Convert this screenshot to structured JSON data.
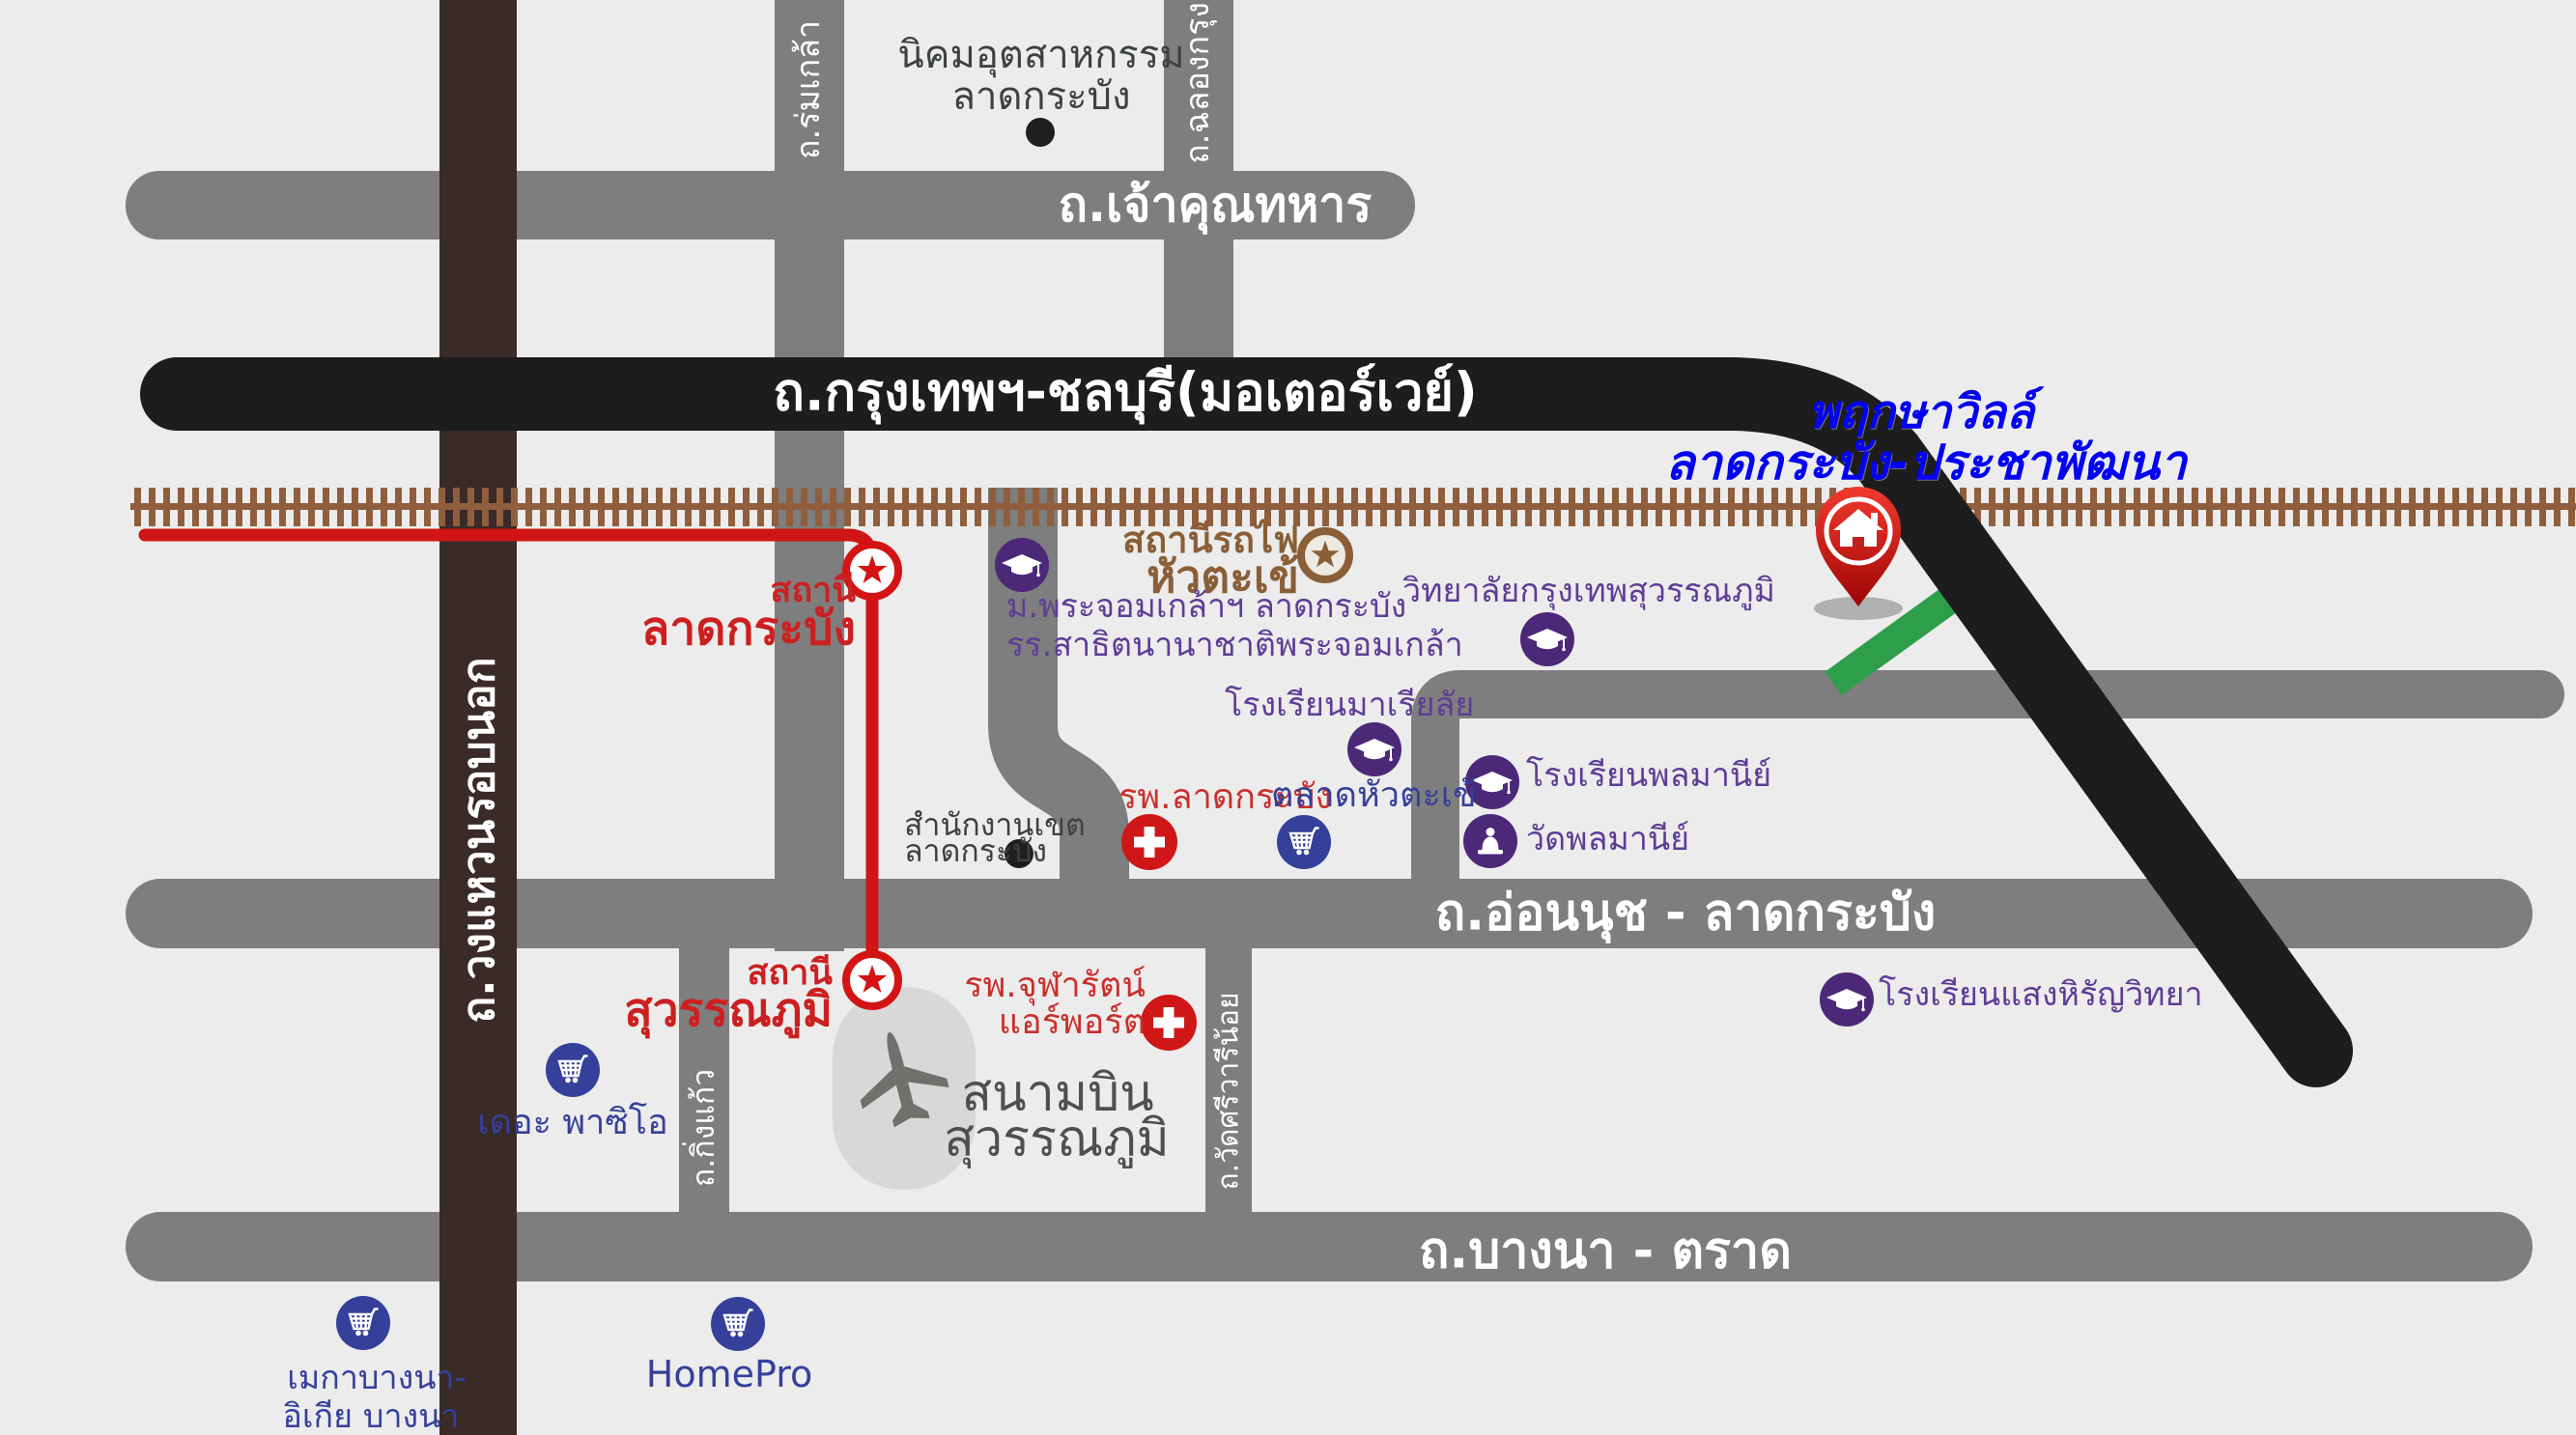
{
  "colors": {
    "background": "#ececec",
    "road_gray": "#7e7e7e",
    "motorway_black": "#1d1d1d",
    "ring_road_brown": "#3a2a28",
    "railway_brown": "#8f5f3d",
    "rail_line_red": "#cf1515",
    "route_green": "#2f9e4a",
    "education_purple": "#4b2878",
    "shopping_blue": "#35409a",
    "hospital_red": "#cf1717",
    "project_blue": "#0404f0",
    "station_brown": "#8a5f38"
  },
  "project": {
    "line1": "พฤกษาวิลล์",
    "line2": "ลาดกระบัง-ประชาพัฒนา"
  },
  "roads": {
    "ring_road": "ถ.วงแหวนรอบนอก",
    "romklao": "ถ.ร่มเกล้า",
    "chalongkrung": "ถ.ฉลองกรุง",
    "chaokhun_thahan": "ถ.เจ้าคุณทหาร",
    "motorway": "ถ.กรุงเทพฯ-ชลบุรี(มอเตอร์เวย์)",
    "onnut_latkrabang": "ถ.อ่อนนุช - ลาดกระบัง",
    "bangna_trat": "ถ.บางนา - ตราด",
    "kingkaeo": "ถ.กิ่งแก้ว",
    "wat_sriwari_noi": "ถ.วัดศรีวารีน้อย"
  },
  "stations": {
    "lat_krabang": {
      "prefix": "สถานี",
      "name": "ลาดกระบัง"
    },
    "suvarnabhumi": {
      "prefix": "สถานี",
      "name": "สุวรรณภูมิ"
    },
    "hua_takhe": {
      "prefix": "สถานีรถไฟ",
      "name": "หัวตะเข้"
    }
  },
  "places": {
    "industrial_estate": {
      "line1": "นิคมอุตสาหกรรม",
      "line2": "ลาดกระบัง"
    },
    "kmitl": {
      "line1": "ม.พระจอมเกล้าฯ ลาดกระบัง",
      "line2": "รร.สาธิตนานาชาติพระจอมเกล้า"
    },
    "bangkok_suvarnabhumi_college": "วิทยาลัยกรุงเทพสุวรรณภูมิ",
    "marialai_school": "โรงเรียนมาเรียลัย",
    "lat_krabang_hospital": "รพ.ลาดกระบัง",
    "hua_takhe_market": "ตลาดหัวตะเข้",
    "district_office": {
      "line1": "สำนักงานเขต",
      "line2": "ลาดกระบัง"
    },
    "phonmani_school": "โรงเรียนพลมานีย์",
    "phonmani_temple": "วัดพลมานีย์",
    "saeng_hirun_school": "โรงเรียนแสงหิรัญวิทยา",
    "chularat_hospital": {
      "line1": "รพ.จุฬารัตน์",
      "line2": "แอร์พอร์ต"
    },
    "airport": {
      "line1": "สนามบิน",
      "line2": "สุวรรณภูมิ"
    },
    "paseo_mall": "เดอะ พาซิโอ",
    "megabangna": {
      "line1": "เมกาบางนา-",
      "line2": "อิเกีย บางนา"
    },
    "homepro": "HomePro"
  },
  "icons": {
    "graduation-cap-icon": "school / university",
    "shopping-cart-icon": "shopping mall / market",
    "hospital-cross-icon": "hospital",
    "temple-icon": "temple",
    "station-star-icon": "rail station marker",
    "home-pin-icon": "project location pin",
    "airplane-icon": "airport",
    "poi-dot-icon": "point of interest"
  }
}
